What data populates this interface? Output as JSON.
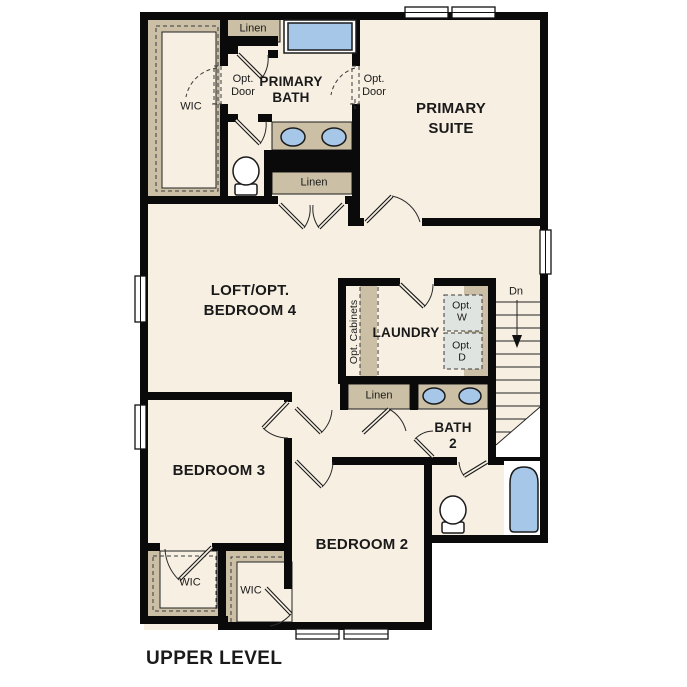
{
  "floorplan": {
    "title": "UPPER LEVEL",
    "colors": {
      "background": "#ffffff",
      "floor": "#f7efe2",
      "closet_counter": "#cbc0a5",
      "wall": "#0a0a0a",
      "fixture_blue": "#a7c7e8",
      "washer_dryer_fill": "#e0e4e0",
      "text": "#1a1a1a"
    },
    "labels": {
      "linen_top": "Linen",
      "wic_primary": "WIC",
      "opt_door_left": "Opt.\nDoor",
      "opt_door_right": "Opt.\nDoor",
      "primary_bath": "PRIMARY\nBATH",
      "primary_suite": "PRIMARY\nSUITE",
      "linen_primary": "Linen",
      "loft": "LOFT/OPT.\nBEDROOM 4",
      "opt_cabinets": "Opt. Cabinets",
      "laundry": "LAUNDRY",
      "opt_washer": "Opt.\nW",
      "opt_dryer": "Opt.\nD",
      "stairs_down": "Dn",
      "linen_hall": "Linen",
      "bath2": "BATH\n2",
      "bedroom3": "BEDROOM 3",
      "bedroom2": "BEDROOM 2",
      "wic_bedroom3": "WIC",
      "wic_bedroom2": "WIC"
    }
  }
}
